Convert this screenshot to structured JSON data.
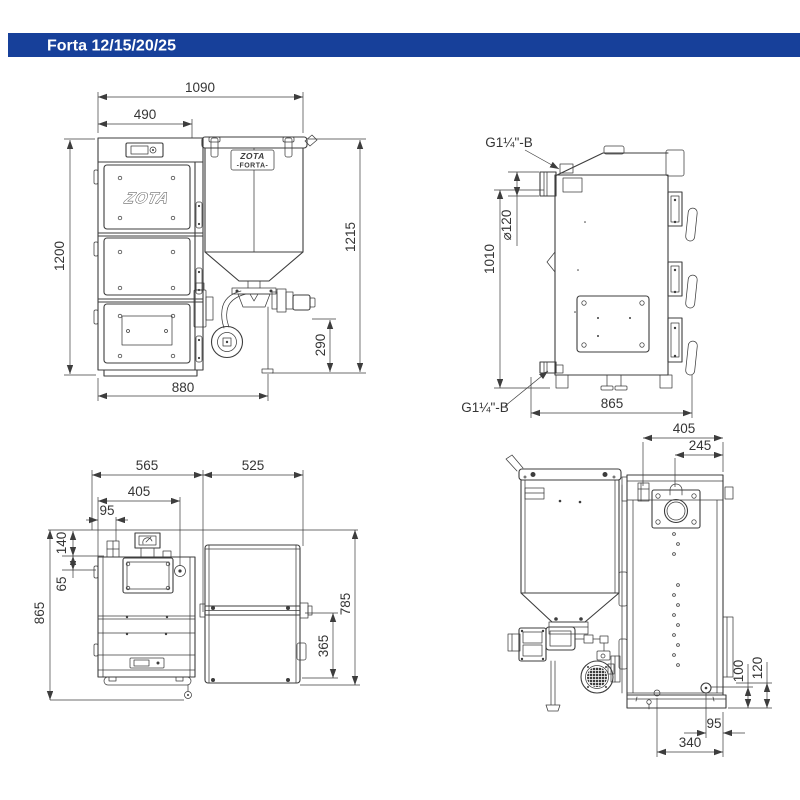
{
  "header": {
    "title": "Forta 12/15/20/25"
  },
  "colors": {
    "header_bar": "#17409a",
    "header_text": "#ffffff",
    "line": "#3d3d3d",
    "dim_text": "#353535"
  },
  "branding": {
    "door_logo": "ZOTA",
    "hopper_plate_logo": "ZOTA",
    "hopper_plate_model": "-FORTA-"
  },
  "views": {
    "front": {
      "dims": {
        "d1090": "1090",
        "d490": "490",
        "d1200": "1200",
        "d1215": "1215",
        "d290": "290",
        "d880": "880"
      }
    },
    "side": {
      "fittings": {
        "top": "G1¼\"-B",
        "bottom": "G1¼\"-B"
      },
      "dims": {
        "d1010": "1010",
        "dflue": "⌀120",
        "d865": "865"
      }
    },
    "plan": {
      "dims": {
        "d565": "565",
        "d525": "525",
        "d405": "405",
        "d95": "95",
        "d140": "140",
        "d65": "65",
        "d865": "865",
        "d785": "785",
        "d365": "365"
      }
    },
    "rear": {
      "dims": {
        "d405": "405",
        "d245": "245",
        "d100": "100",
        "d120": "120",
        "d95": "95",
        "d340": "340"
      }
    }
  }
}
